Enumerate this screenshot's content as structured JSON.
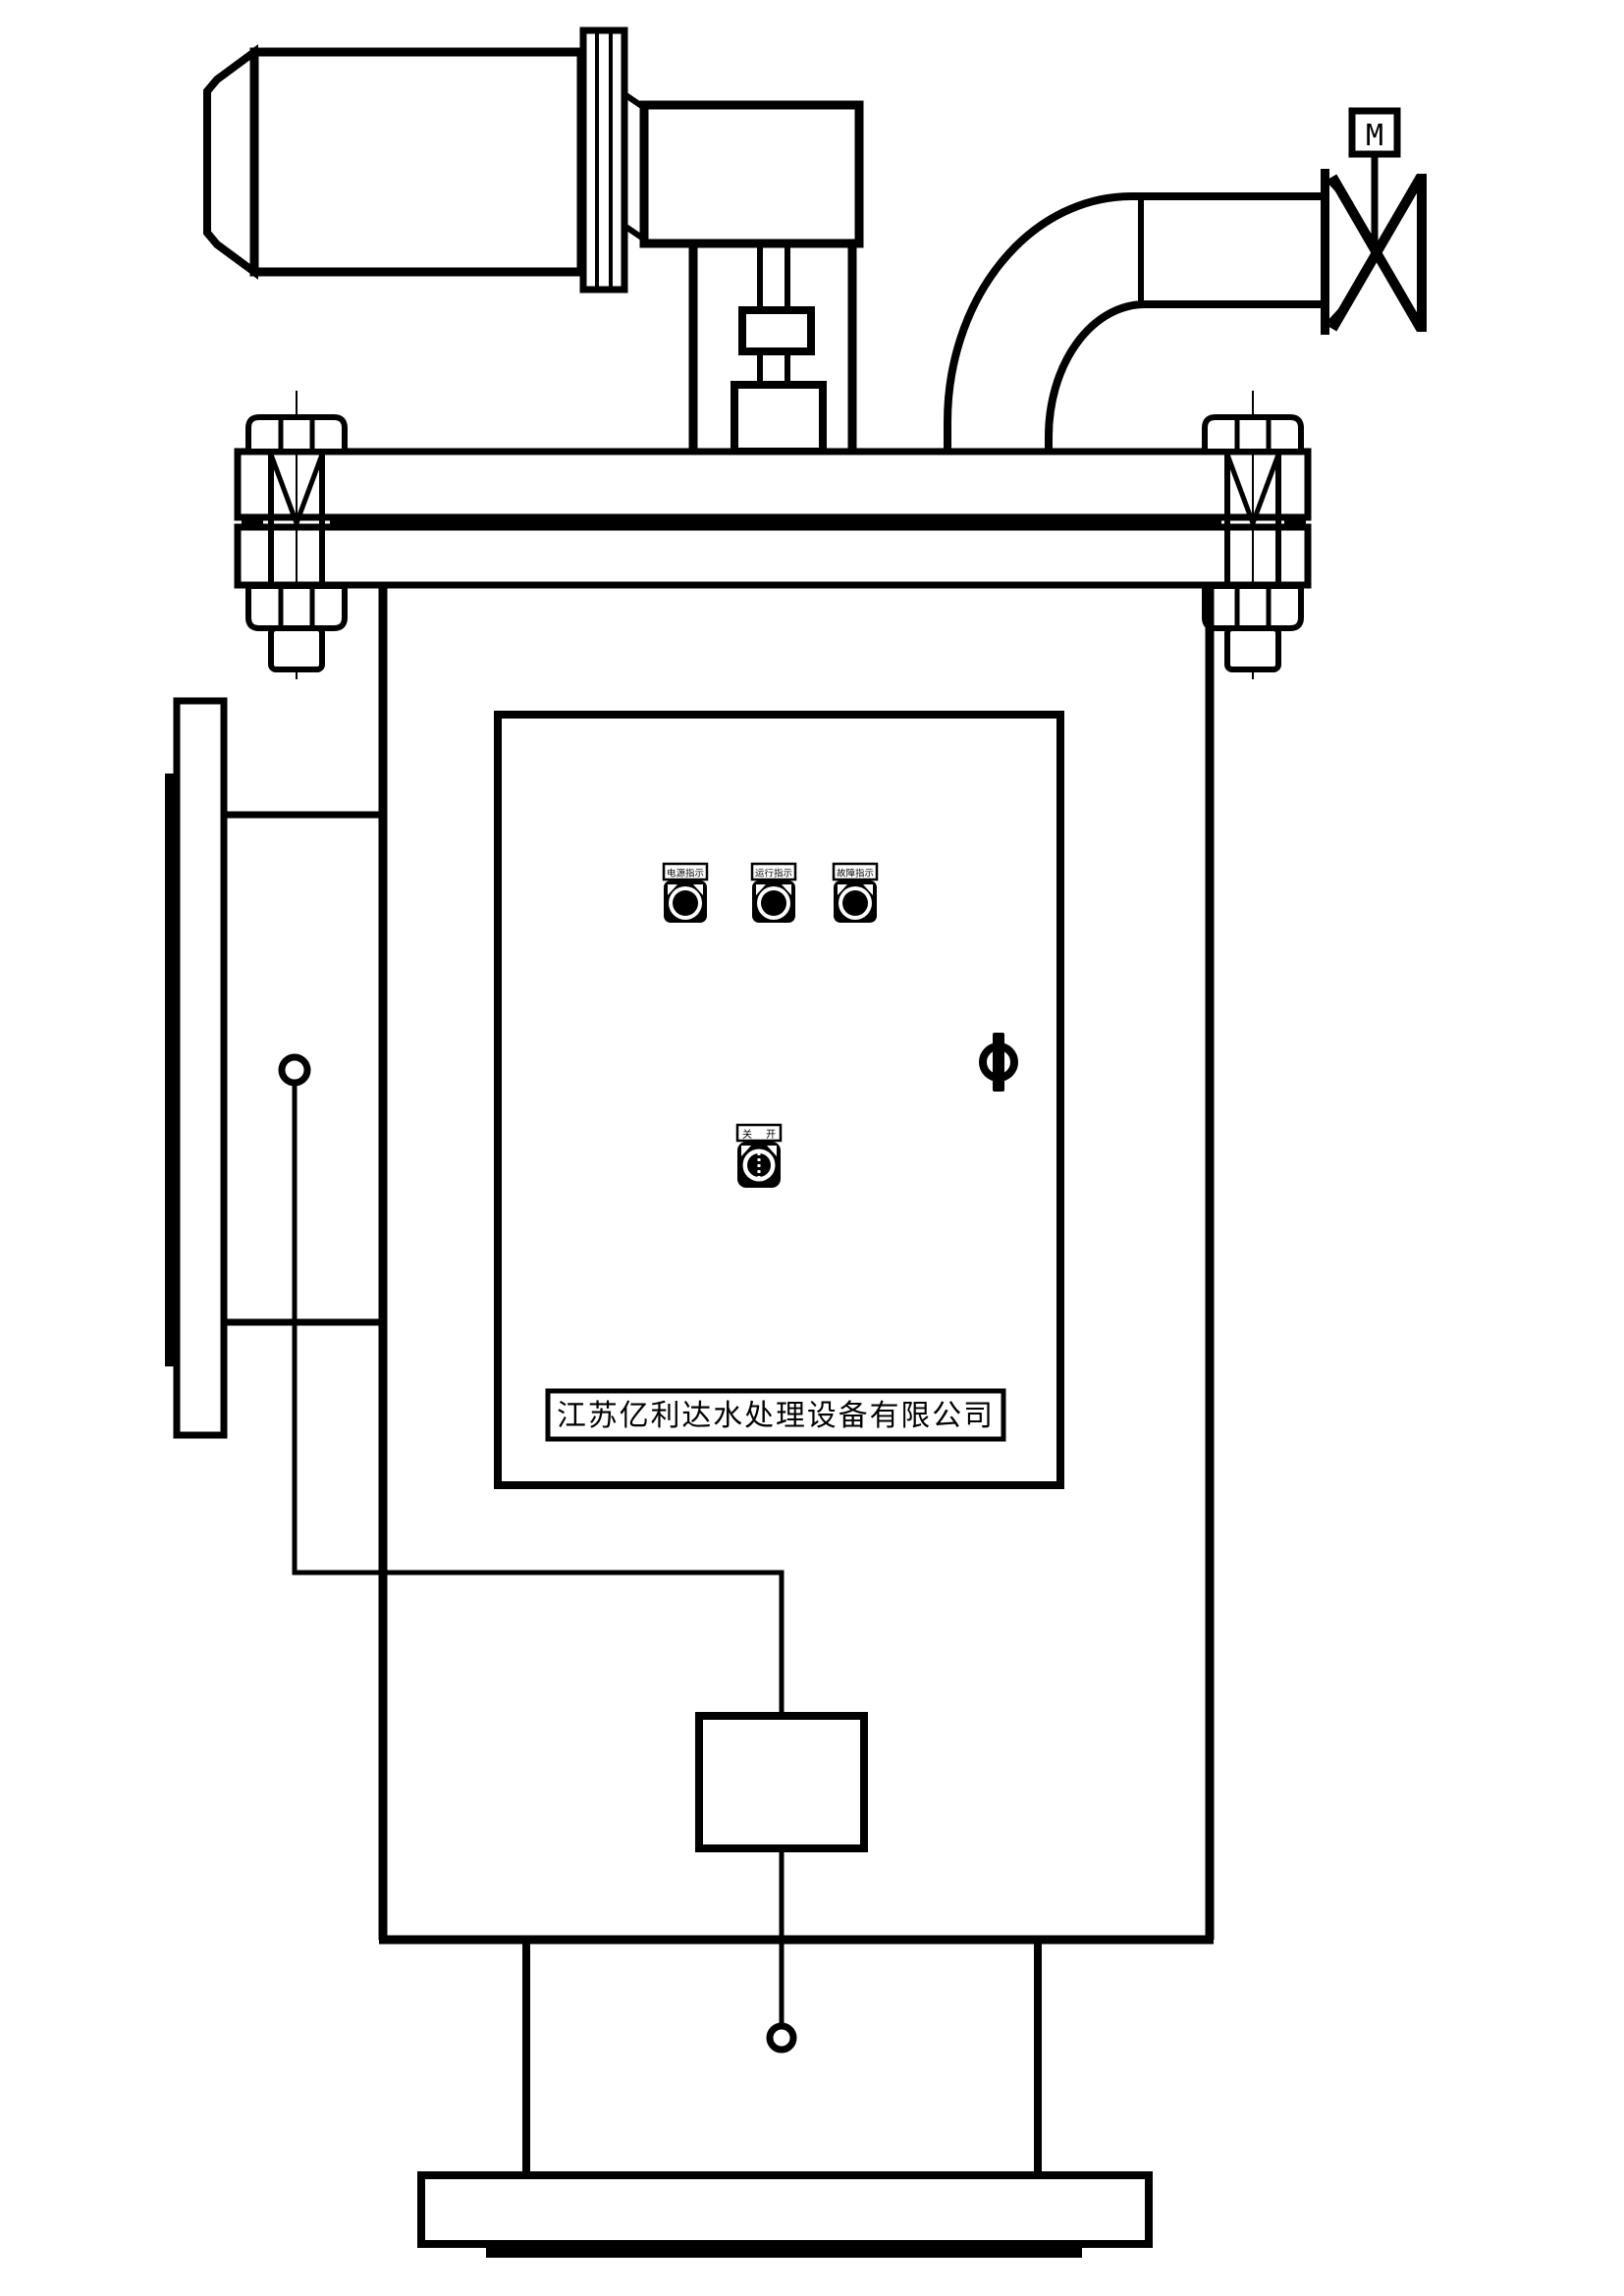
{
  "drawing": {
    "type": "technical-line-drawing",
    "subject": "自动排污水过滤器总装图",
    "colors": {
      "line": "#000000",
      "background": "#ffffff"
    }
  },
  "valve": {
    "actuator_label": "M"
  },
  "control_panel": {
    "indicator_buttons": [
      {
        "label": "电源指示"
      },
      {
        "label": "运行指示"
      },
      {
        "label": "故障指示"
      }
    ],
    "selector_switch": {
      "label_left": "关",
      "label_right": "开"
    },
    "nameplate": "江苏亿利达水处理设备有限公司"
  }
}
